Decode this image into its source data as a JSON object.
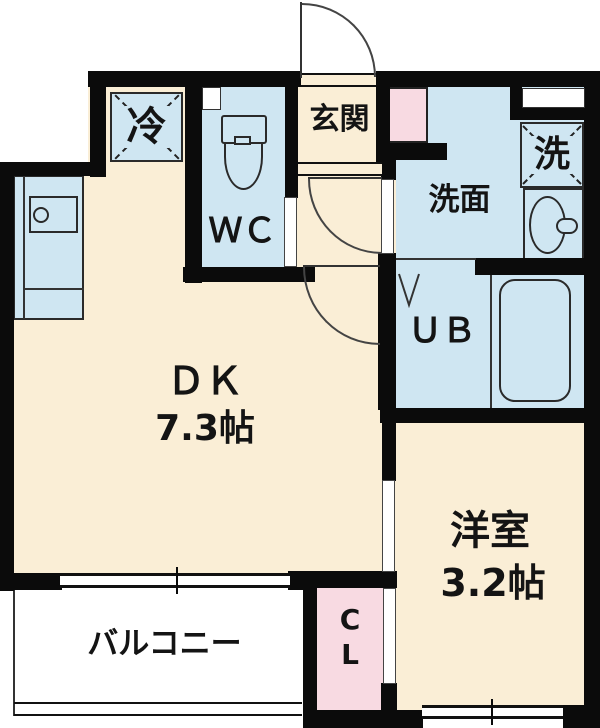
{
  "colors": {
    "floor_cream": "#FAEED6",
    "wet_area_blue": "#CFE6F2",
    "closet_pink": "#F8DAE2",
    "wall_black": "#0B0B0B",
    "line_gray": "#333333",
    "background": "#FFFFFF"
  },
  "rooms": {
    "dk": {
      "label": "ＤＫ",
      "size": "7.3帖"
    },
    "western_room": {
      "label": "洋室",
      "size": "3.2帖"
    },
    "entrance": {
      "label": "玄関"
    },
    "toilet": {
      "label": "ＷＣ"
    },
    "washroom": {
      "label": "洗面"
    },
    "unit_bath": {
      "label": "ＵＢ"
    },
    "balcony": {
      "label": "バルコニー"
    },
    "closet": {
      "label": "CL"
    },
    "refrigerator_space": {
      "label": "冷"
    },
    "washer_space": {
      "label": "洗"
    }
  }
}
